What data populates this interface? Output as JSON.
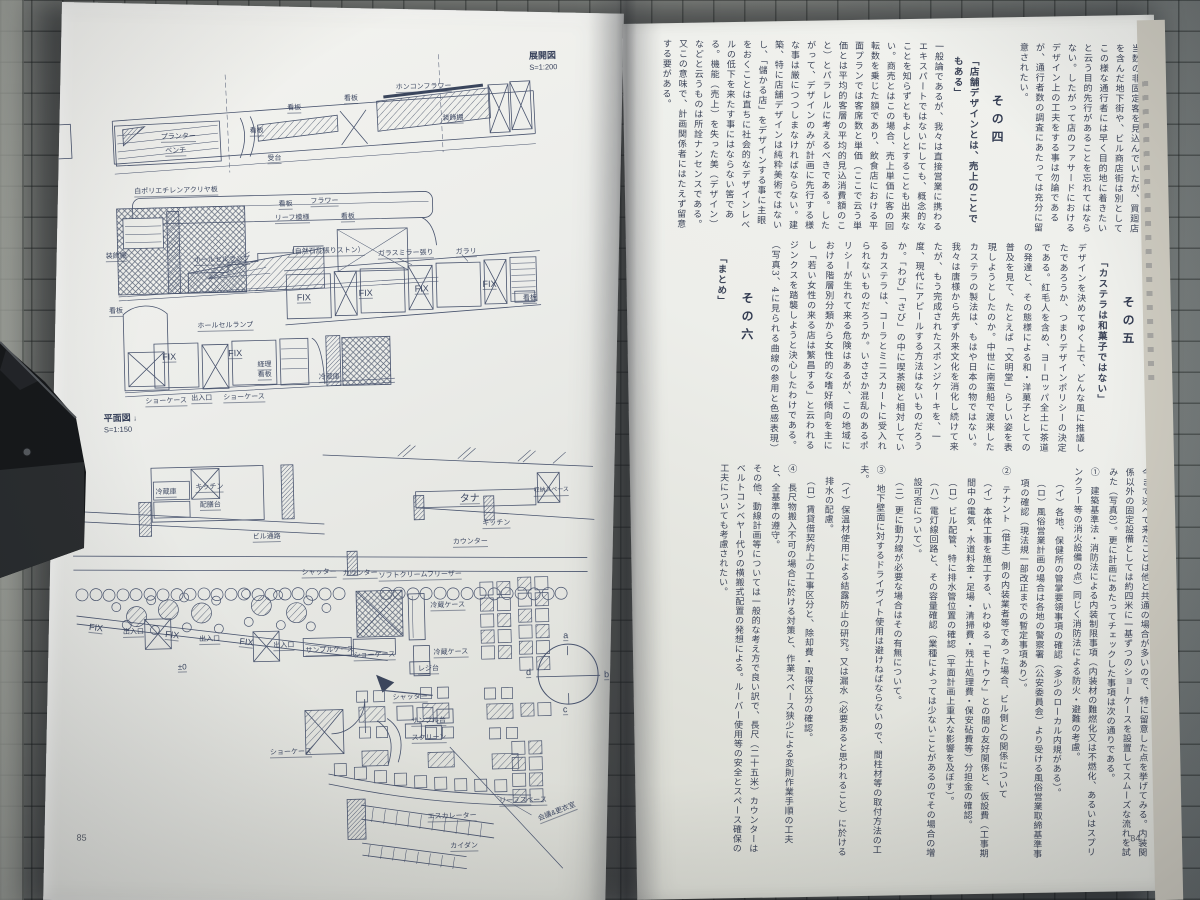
{
  "palette": {
    "mat": "#8e918b",
    "grid_line": "#2a2f2c",
    "paper": "#edeeea",
    "ink": "#49546e"
  },
  "book": {
    "left_page": {
      "page_number": "85",
      "elevation_title": "展開図",
      "elevation_scale": "S=1:200",
      "plan_title": "平面図",
      "plan_arrow": "↓",
      "plan_scale": "S=1:150",
      "elevation_labels": [
        {
          "t": "ホンコンフラワー",
          "x": 352,
          "y": 78
        },
        {
          "t": "装飾棚",
          "x": 398,
          "y": 110
        },
        {
          "t": "看板",
          "x": 300,
          "y": 88
        },
        {
          "t": "看板",
          "x": 243,
          "y": 96
        },
        {
          "t": "看板",
          "x": 205,
          "y": 118
        },
        {
          "t": "プランター",
          "x": 116,
          "y": 122
        },
        {
          "t": "ベンチ",
          "x": 120,
          "y": 136
        },
        {
          "t": "受台",
          "x": 222,
          "y": 146
        },
        {
          "t": "白ポリエチレンアクリヤ板",
          "x": 88,
          "y": 176
        },
        {
          "t": "看板",
          "x": 232,
          "y": 192
        },
        {
          "t": "フラワー",
          "x": 264,
          "y": 190
        },
        {
          "t": "リーフ模様",
          "x": 228,
          "y": 206
        },
        {
          "t": "看板",
          "x": 294,
          "y": 206
        },
        {
          "t": "装飾棚",
          "x": 58,
          "y": 240
        },
        {
          "t": "ホールセルランプ",
          "x": 146,
          "y": 246
        },
        {
          "t": "（自然石乱張りストン）",
          "x": 240,
          "y": 240
        },
        {
          "t": "ガラスミラー張り",
          "x": 330,
          "y": 244
        },
        {
          "t": "ガラリ",
          "x": 408,
          "y": 244
        },
        {
          "t": "FIX",
          "x": 248,
          "y": 286,
          "s": 9
        },
        {
          "t": "FIX",
          "x": 310,
          "y": 283,
          "s": 9
        },
        {
          "t": "FIX",
          "x": 366,
          "y": 280,
          "s": 9
        },
        {
          "t": "FIX",
          "x": 434,
          "y": 277,
          "s": 9
        },
        {
          "t": "看板",
          "x": 474,
          "y": 292
        },
        {
          "t": "看板",
          "x": 60,
          "y": 295
        },
        {
          "t": "ホールセルランプ",
          "x": 148,
          "y": 312
        },
        {
          "t": "FIX",
          "x": 112,
          "y": 342,
          "s": 9
        },
        {
          "t": "FIX",
          "x": 178,
          "y": 340,
          "s": 9
        },
        {
          "t": "経理",
          "x": 207,
          "y": 352
        },
        {
          "t": "看板",
          "x": 207,
          "y": 362
        },
        {
          "t": "冷蔵庫",
          "x": 268,
          "y": 366
        },
        {
          "t": "ショーケース",
          "x": 94,
          "y": 386
        },
        {
          "t": "出入口",
          "x": 140,
          "y": 384
        },
        {
          "t": "ショーケース",
          "x": 172,
          "y": 384
        }
      ],
      "plan_labels": [
        {
          "t": "冷蔵庫",
          "x": 102,
          "y": 477
        },
        {
          "t": "キッチン",
          "x": 142,
          "y": 473
        },
        {
          "t": "配膳台",
          "x": 146,
          "y": 491
        },
        {
          "t": "タナ",
          "x": 406,
          "y": 491,
          "s": 10
        },
        {
          "t": "収納スペース",
          "x": 480,
          "y": 485,
          "s": 6
        },
        {
          "t": "キッチン",
          "x": 428,
          "y": 516
        },
        {
          "t": "ビル通路",
          "x": 198,
          "y": 524
        },
        {
          "t": "カウンター",
          "x": 398,
          "y": 534
        },
        {
          "t": "シャッター",
          "x": 246,
          "y": 561
        },
        {
          "t": "カウンター",
          "x": 287,
          "y": 563
        },
        {
          "t": "ソフトクリームフリーザー",
          "x": 323,
          "y": 566
        },
        {
          "t": "FIX",
          "x": 32,
          "y": 611,
          "s": 9,
          "r": 8
        },
        {
          "t": "出入口",
          "x": 66,
          "y": 616
        },
        {
          "t": "FIX",
          "x": 108,
          "y": 620,
          "s": 9,
          "r": 8
        },
        {
          "t": "出入口",
          "x": 142,
          "y": 625
        },
        {
          "t": "FIX",
          "x": 182,
          "y": 629,
          "s": 9,
          "r": 8
        },
        {
          "t": "出入口",
          "x": 216,
          "y": 633
        },
        {
          "t": "サンプルケース",
          "x": 248,
          "y": 639
        },
        {
          "t": "冷蔵ケース",
          "x": 374,
          "y": 597
        },
        {
          "t": "ショーケース",
          "x": 296,
          "y": 645
        },
        {
          "t": "冷蔵ケース",
          "x": 376,
          "y": 644
        },
        {
          "t": "レジ台",
          "x": 360,
          "y": 660
        },
        {
          "t": "シャッター",
          "x": 334,
          "y": 688
        },
        {
          "t": "サンプル台",
          "x": 352,
          "y": 712
        },
        {
          "t": "±0",
          "x": 120,
          "y": 652,
          "s": 8
        },
        {
          "t": "a",
          "x": 506,
          "y": 630,
          "s": 9
        },
        {
          "t": "d",
          "x": 468,
          "y": 666,
          "s": 9
        },
        {
          "t": "b",
          "x": 546,
          "y": 670,
          "s": 9
        },
        {
          "t": "c",
          "x": 504,
          "y": 704,
          "s": 9
        },
        {
          "t": "スクリーン",
          "x": 352,
          "y": 729
        },
        {
          "t": "ショーケース",
          "x": 210,
          "y": 740
        },
        {
          "t": "リーフスペース",
          "x": 438,
          "y": 794
        },
        {
          "t": "エスカレーター",
          "x": 366,
          "y": 808
        },
        {
          "t": "カイダン",
          "x": 388,
          "y": 838
        },
        {
          "t": "会議&更衣室",
          "x": 476,
          "y": 806,
          "r": -20
        }
      ]
    },
    "right_page": {
      "page_number": "84",
      "tiers": [
        {
          "id": "tier-a",
          "runs": [
            {
              "k": "body",
              "t": "当数の非固定客を見込んでいたが、買廻店を含んだ地下街や、ビル商店街は別としてこの様な通行者には早く目的地に着きたいと云う目的先行があることを忘れてはならない。したがって店のファサードにおけるデザイン上の工夫をする事は勿論であるが、通行者数の調査にあたっては充分に留意されたい。"
            },
            {
              "k": "head",
              "t": "その四"
            },
            {
              "k": "quote",
              "t": "「店舗デザインとは、売上のことでもある」"
            },
            {
              "k": "body",
              "t": "一般論であるが、我々は直接営業に携わるエキスパートではないにしても、概念的なことを知らずともよしとすることも出来ない。商売とはこの場合、売上単価に客の回転数を乗じた額であり、飲食店における平面プランでは客席数と単価（ここで云う単価とは平均的客層の平均的見込消費額のこと）とパラレルに考えるべきである。したがって、デザインのみが計画に先行する様な事は厳につつしまなければならない。"
            },
            {
              "k": "body",
              "t": "建築、特に店舗デザインは純粋美術ではないし、「儲かる店」をデザインする事に主眼をおくことは直ちに社会的なデザインレベルの低下を来たす事にはならない筈である。機能（売上）を失った美（デザイン）などと云うものは所詮ナンセンスである。又この意味で、計画関係者にはたえず留意する要がある。"
            }
          ]
        },
        {
          "id": "tier-b",
          "runs": [
            {
              "k": "head",
              "t": "その五"
            },
            {
              "k": "quote",
              "t": "「カステラは和菓子ではない」"
            },
            {
              "k": "body",
              "t": "デザインを決めてゆく上で、どんな風に推議したであろうか、つまりデザインポリシーの決定である。紅毛人を含め、ヨーロッパ全土に茶道の発達と、その態様による和・洋菓子としての普及を見て、たとえば「文明堂」らしい姿を表現しようとしたのか。中世に南蛮船で渡来したカステラの製法は、もはや日本の物ではない。我々は唐様から先ず外来文化を消化し続けて来たが、もう完成されたスポンジケーキを、一度、現代にアピールする方法はないものだろうか。「わび」「さび」の中に喫茶碗と相対しているカステラは、コーラとミニスカートに受入れられないものだろうか。"
            },
            {
              "k": "body",
              "t": "いささか混乱のあるポリシーが生れて来る危険はあるが、この地域における階層別分類から女性的な嗜好傾向を主にし「若い女性の来る店は繁昌する」と云われるジンクスを踏襲しようと決心したわけである。（写真3、4に見られる曲線の参用と色感表現）"
            },
            {
              "k": "head",
              "t": "その六"
            },
            {
              "k": "quote",
              "t": "「まとめ」"
            }
          ]
        },
        {
          "id": "tier-c",
          "runs": [
            {
              "k": "body",
              "t": "今まで述べて来たことは他と共通の場合が多いので、特に留意した点を挙げてみる。内装関係以外の固定設備としては約四米に一基ずつのショーケースを設置してスムーズな流れを試みた（写真8）。更に計画にあたってチェックした事項は次の通りである。"
            },
            {
              "k": "item",
              "t": "①　建築基準法・消防法による内装制限事項（内装材の難燃化又は不燃化、あるいはスプリンクラー等の消火設備の点）同じく消防法による防火・避難の考慮。"
            },
            {
              "k": "sub",
              "t": "（イ）各地、保健所の管掌要領事項の確認（多少のローカル内規がある）。"
            },
            {
              "k": "sub",
              "t": "（ロ）風俗営業計画の場合は各地の警察署（公安委員会）より受ける風俗営業取締基準事項の確認（現法規一部改正までの暫定事項あり）。"
            },
            {
              "k": "item",
              "t": "②　テナント（借主）側の内装業者等であった場合、ビル側との関係について"
            },
            {
              "k": "sub",
              "t": "（イ）本体工事を施工する、いわゆる「モトウケ」との間の友好関係と、仮設費（工事期間中の電気・水道料金・足場・清掃費・残土処理費・保安砧費等）分担金の確認。"
            },
            {
              "k": "sub",
              "t": "（ロ）ビル配管、特に排水管位置の確認（平面計画上重大な影響を及ぼす）。"
            },
            {
              "k": "sub",
              "t": "（ハ）電灯線回路と、その容量確認（業種によっては少ないことがあるのでその場合の増設可否について）。"
            },
            {
              "k": "sub",
              "t": "（ニ）更に動力線が必要な場合はその有無について。"
            },
            {
              "k": "item",
              "t": "③　地下壁面に対するドライヴイト使用は避けねばならないので、間柱材等の取付方法の工夫。"
            },
            {
              "k": "sub",
              "t": "（イ）保温材使用による結露防止の研究。又は漏水（必要あると思われること）に於ける排水の配慮。"
            },
            {
              "k": "sub",
              "t": "（ロ）賃貸借契約上の工事区分と、除却費・取得区分の確認。"
            },
            {
              "k": "item",
              "t": "④　長尺物搬入不可の場合に於ける対策と、作業スペース狭少による変則作業手順の工夫と、全基準の遵守。"
            },
            {
              "k": "item",
              "t": "その他、動線計画等については一般的な考え方で良い訳で、長尺（二十五米）カウンターはベルトコンベヤー代りの横搬式配置の発想による。ルーバー使用等の安全とスペース確保の工夫についても考慮されたい。"
            }
          ]
        }
      ]
    }
  }
}
